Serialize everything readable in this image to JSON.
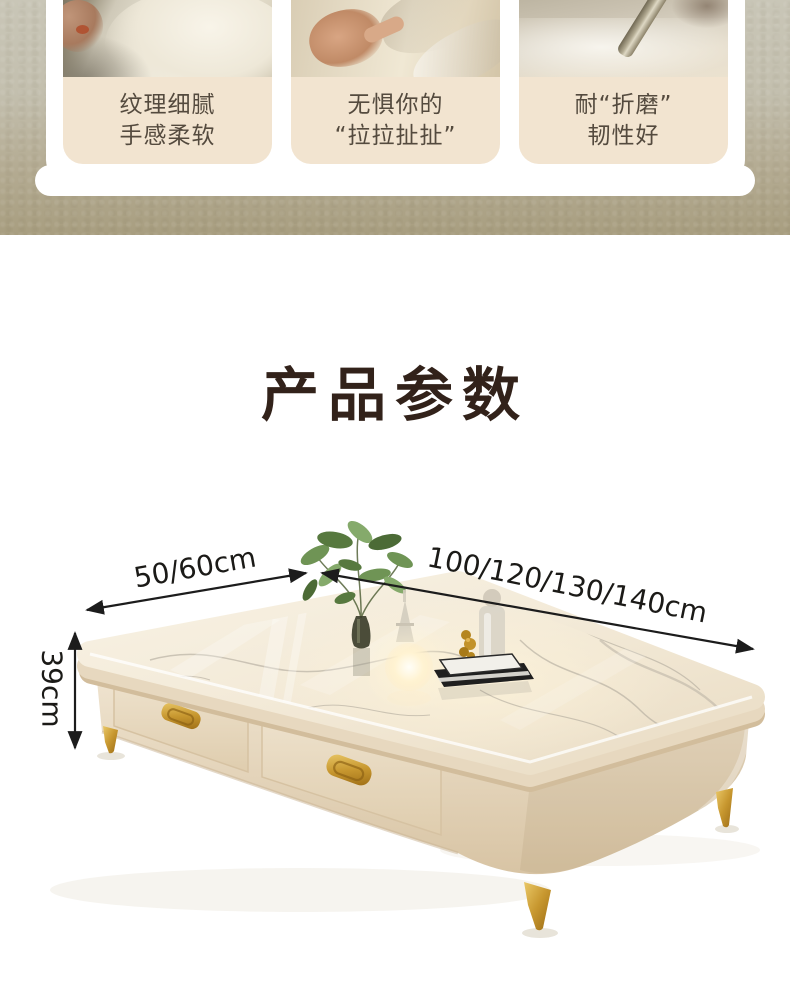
{
  "features": [
    {
      "photo": "hand-holding-soft-fabric-closeup",
      "line1": "纹理细腻",
      "line2": "手感柔软"
    },
    {
      "photo": "hand-pulling-stretching-fabric",
      "line1": "无惧你的",
      "line2": "“拉拉扯扯”"
    },
    {
      "photo": "metal-tool-abrasion-test-on-fabric",
      "line1": "耐“折磨”",
      "line2": "韧性好"
    }
  ],
  "section": {
    "title": "产品参数"
  },
  "diagram": {
    "depth_label": "50/60cm",
    "width_label": "100/120/130/140cm",
    "height_label": "39cm",
    "subject": "cream coffee table with glossy stone top, two drawers, gold handles and tapered gold legs, decorated with plant, lamp, perfume bottle and books"
  },
  "colors": {
    "wall_background": "#b7ae97",
    "card_background": "#f2e4d0",
    "caption_text": "#544a3e",
    "panel_white": "#ffffff",
    "title_text": "#32221a",
    "dimension_text": "#1b1a17",
    "table_body": "#e9dcc5",
    "marble_top": "#f5efe1",
    "gold_accent": "#c7982f"
  }
}
